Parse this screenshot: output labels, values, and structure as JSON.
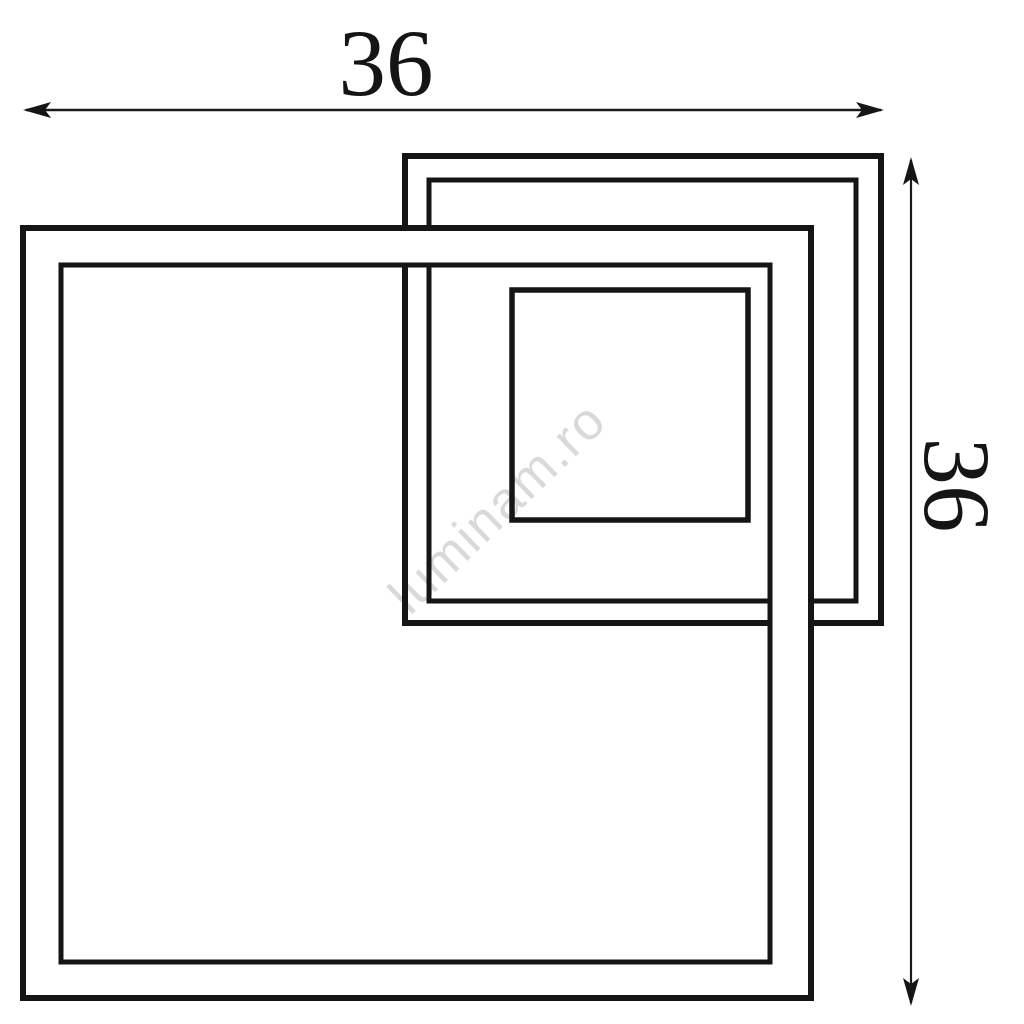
{
  "diagram": {
    "watermark": "luminam.ro",
    "width_dimension": {
      "label": "36"
    },
    "height_dimension": {
      "label": "36"
    },
    "colors": {
      "line": "#151515",
      "thin_line": "#1a1a1a",
      "watermark": "#d9d9d9",
      "background": "#ffffff"
    }
  }
}
